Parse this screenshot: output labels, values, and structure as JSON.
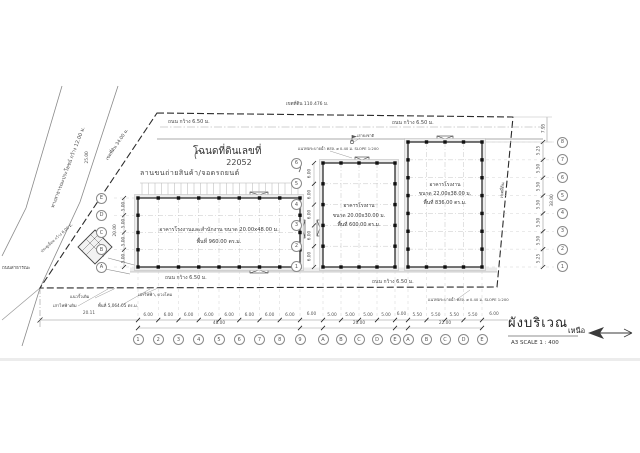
{
  "sheet": {
    "deed_label": "โฉนดที่ดินเลขที่",
    "deed_number": "22052",
    "plan_title": "ผังบริเวณ",
    "plan_scale": "A3 SCALE 1 : 400",
    "north_label": "เหนือ"
  },
  "site": {
    "yard_label": "ลานขนถ่ายสินค้า/จอดรถยนต์",
    "boundary_top": "เขตที่ดิน 110.476 ม.",
    "boundary_left": "เขตที่ดิน 34.00 ม.",
    "boundary_right": "เขตที่ดิน",
    "public_road": "ทางสาธารณะประโยชน์ กว้าง 12.00 ม.",
    "public_road_short": "ถนนสาธารณะ",
    "road_width": "ถนน กว้าง 6.50 ม.",
    "drain": "แนวท่อระบายน้ำ คสล. ø 0.40 ม. SLOPE 1:200",
    "flag_pole": "เสาธงชาติ",
    "fence": "แนวรั้วเดิม",
    "power_pole": "เสาไฟฟ้าเดิม",
    "lamp_posts": "เสาไฟฟ้า, ดวงโคม",
    "site_area": "พื้นที่ 5,064.05 ตร.ม.",
    "gate": "ประตูเลื่อน กว้าง 6.00 ม."
  },
  "buildings": {
    "b1": {
      "line1": "อาคารโรงงานและสำนักงาน ขนาด 20.00x48.00 ม.",
      "line2": "พื้นที่ 960.00 ตร.ม."
    },
    "b2": {
      "line1": "อาคารโรงงาน",
      "line2": "ขนาด 20.00x30.00 ม.",
      "line3": "พื้นที่ 600.00 ตร.ม."
    },
    "b3": {
      "line1": "อาคารโรงงาน",
      "line2": "ขนาด 22.00x38.00 ม.",
      "line3": "พื้นที่ 836.00 ตร.ม."
    }
  },
  "grids": {
    "bottom_main": [
      "1",
      "2",
      "3",
      "4",
      "5",
      "6",
      "7",
      "8",
      "9"
    ],
    "bottom_mid": [
      "A",
      "B",
      "C",
      "D",
      "E"
    ],
    "bottom_right": [
      "A",
      "B",
      "C",
      "D",
      "E"
    ],
    "right_col": [
      "8",
      "7",
      "6",
      "5",
      "4",
      "3",
      "2",
      "1"
    ],
    "left_main": [
      "E",
      "D",
      "C",
      "B",
      "A"
    ],
    "mid_left": [
      "6",
      "5",
      "4",
      "3",
      "2",
      "1"
    ]
  },
  "dims": {
    "main_bays": [
      "6.00",
      "6.00",
      "6.00",
      "6.00",
      "6.00",
      "6.00",
      "6.00",
      "6.00"
    ],
    "main_total": "48.00",
    "mid_bays": [
      "5.00",
      "5.00",
      "5.00",
      "5.00"
    ],
    "mid_total": "20.00",
    "right_bays": [
      "5.50",
      "5.50",
      "5.50",
      "5.50"
    ],
    "right_total": "22.00",
    "gap1": "6.00",
    "gap2": "6.00",
    "gap3": "6.00",
    "left_offset": "20.11",
    "right_vert": [
      "5.25",
      "5.50",
      "5.50",
      "5.50",
      "5.50",
      "5.50",
      "5.25"
    ],
    "right_vert_total": "38.00",
    "right_top": "7.95",
    "left_boundary_dim": "25.00",
    "main_side_bays": [
      "5.00",
      "5.00",
      "5.00",
      "5.00"
    ],
    "main_side_total": "20.00",
    "mid_side_bays": [
      "6.00",
      "6.00",
      "6.00",
      "6.00",
      "6.00"
    ]
  }
}
